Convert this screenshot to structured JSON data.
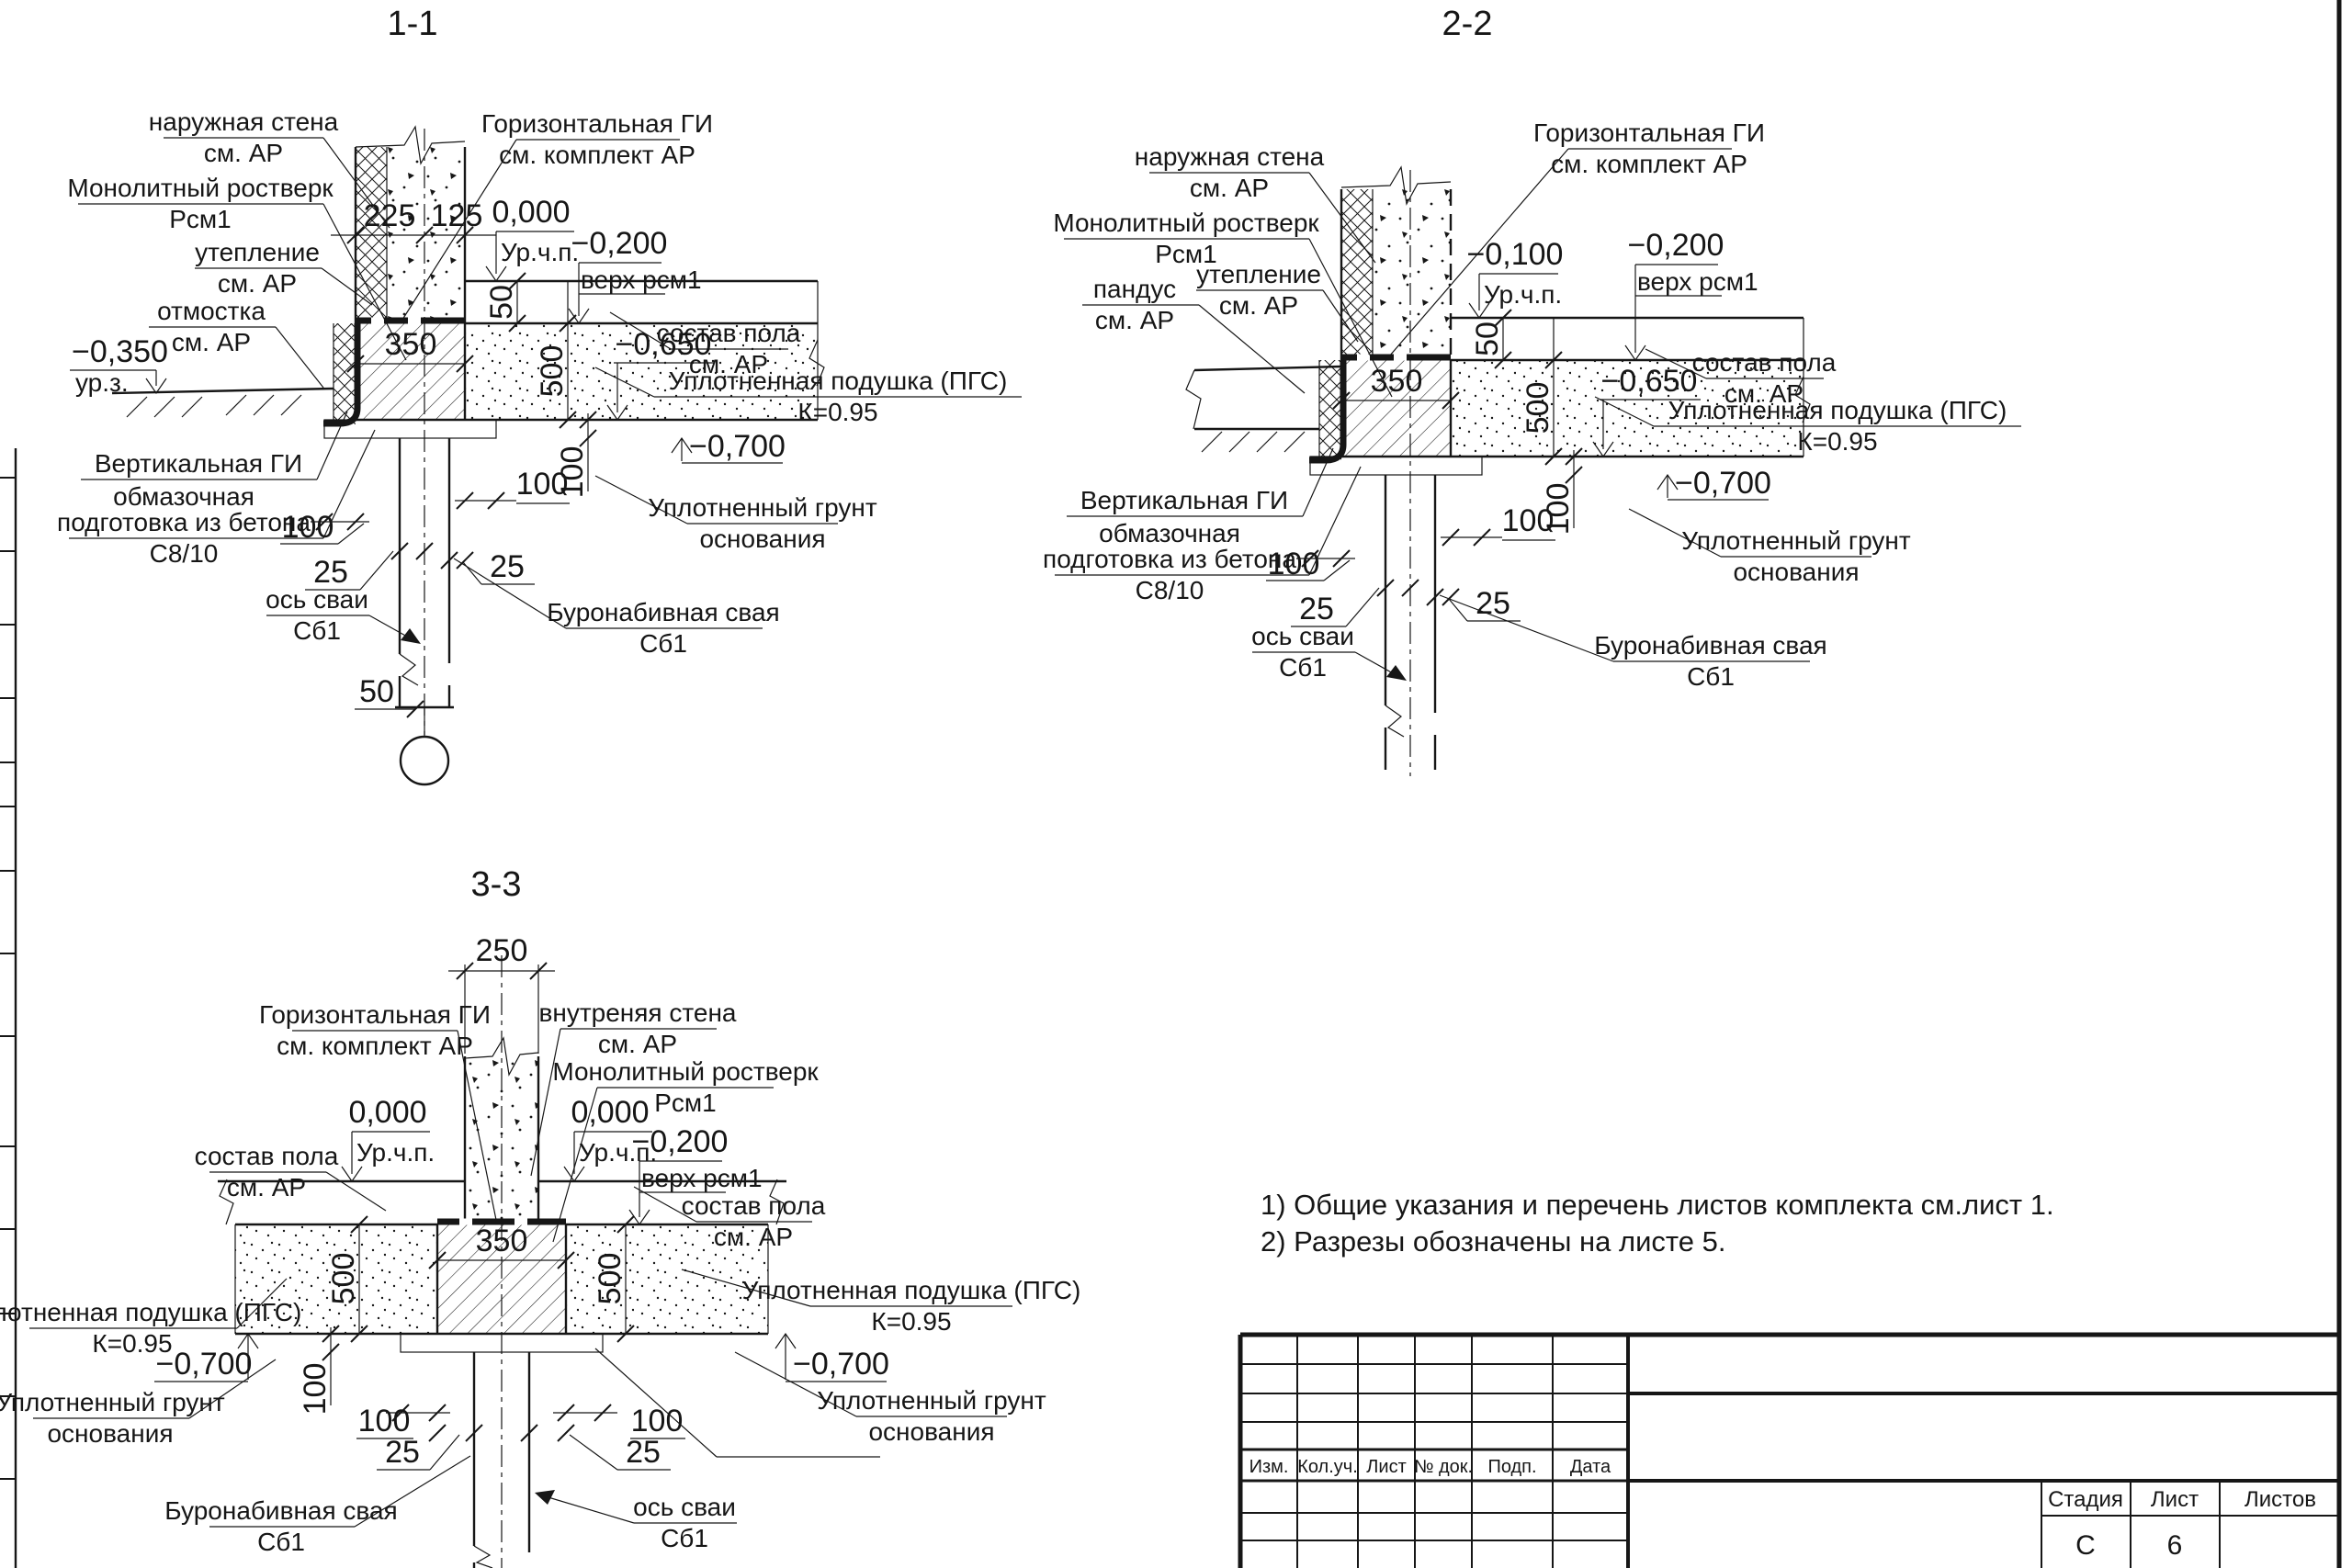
{
  "sheet": {
    "background": "#ffffff",
    "ink": "#161616"
  },
  "titles": {
    "s1": "1-1",
    "s2": "2-2",
    "s3": "3-3"
  },
  "labels": {
    "ow": "наружная стена",
    "iw": "внутреняя стена",
    "ar": "см. АР",
    "mr1": "Монолитный ростверк",
    "mr2": "Рсм1",
    "ut": "утепление",
    "otm": "отмостка",
    "pan": "пандус",
    "vgi": "Вертикальная ГИ",
    "ob1": "обмазочная",
    "ob2": "подготовка из бетона",
    "ob3": "С8/10",
    "os1": "ось сваи",
    "os2": "Сб1",
    "hgi1": "Горизонтальная ГИ",
    "hgi2": "см. комплект АР",
    "sp": "состав пола",
    "up1": "Уплотненная подушка (ПГС)",
    "up2": "К=0.95",
    "ug1": "Уплотненный грунт",
    "ug2": "основания",
    "bs1": "Буронабивная свая",
    "bs2": "Сб1",
    "urchp": "Ур.ч.п.",
    "urz": "ур.з.",
    "vrsm": "верх рсм1"
  },
  "levels": {
    "l0": "0,000",
    "l100": "−0,100",
    "l200": "−0,200",
    "l350": "−0,350",
    "l650": "−0,650",
    "l700": "−0,700"
  },
  "dims": {
    "d225": "225",
    "d125": "125",
    "d250": "250",
    "d350": "350",
    "d500": "500",
    "d100": "100",
    "d50": "50",
    "d25": "25"
  },
  "notes": {
    "n1": "1) Общие указания и перечень листов комплекта см.лист 1.",
    "n2": "2) Разрезы обозначены на листе 5."
  },
  "titleblock": {
    "izm": "Изм.",
    "kol": "Кол.уч.",
    "list": "Лист",
    "ndok": "№ док.",
    "podp": "Подп.",
    "data": "Дата",
    "stage_h": "Стадия",
    "sheet_h": "Лист",
    "sheets_h": "Листов",
    "stage_v": "С",
    "sheet_v": "6",
    "sheets_v": ""
  }
}
